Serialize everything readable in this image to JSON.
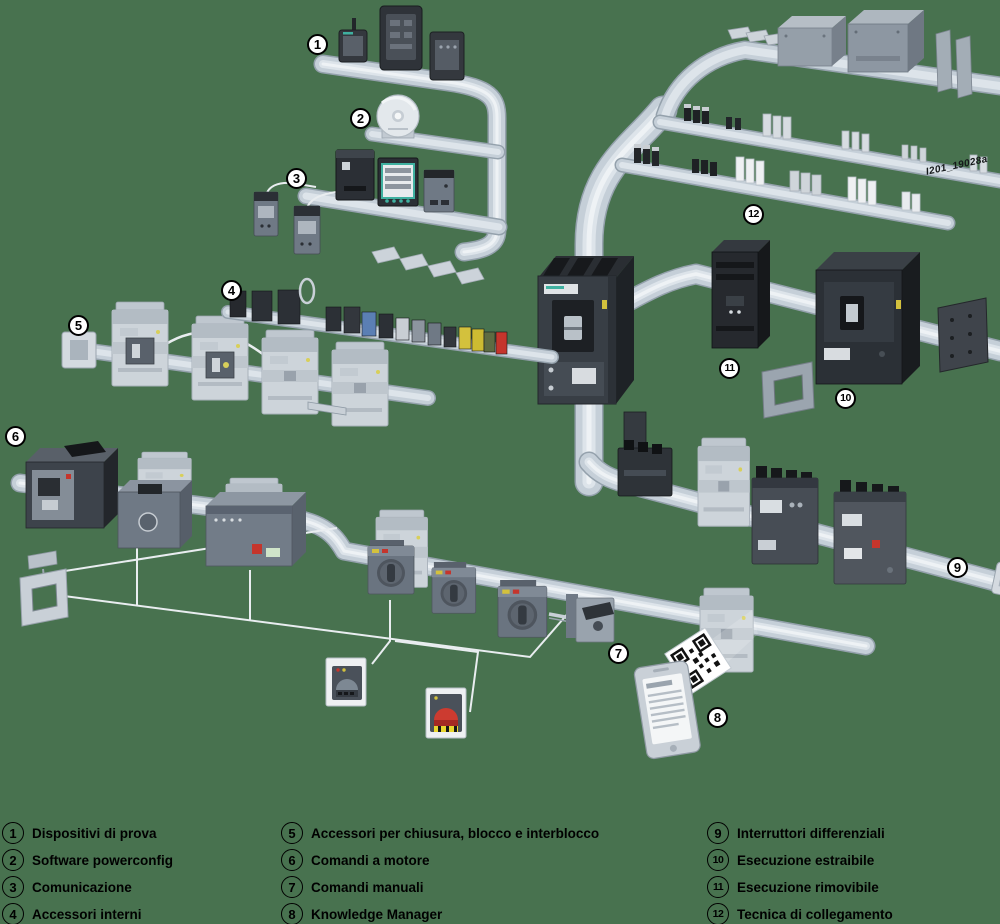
{
  "watermark": "I201_19028a",
  "colors": {
    "background": "#48724f",
    "pipe": "#c5cfd8",
    "pipe_shadow": "#94a1ac",
    "pipe_highlight": "#e9eef2",
    "device_dark": "#26292e",
    "device_gray": "#6f7985",
    "device_light": "#cdd4da",
    "accent_teal": "#3fb0a0",
    "accent_red": "#c5352c",
    "accent_yellow": "#d3c13d",
    "accent_blue": "#5b7fb4",
    "accent_green": "#5d6b42",
    "wire": "#e9edf0",
    "text": "#000000",
    "callout_bg": "#ffffff"
  },
  "callouts": [
    {
      "num": "1"
    },
    {
      "num": "2"
    },
    {
      "num": "3"
    },
    {
      "num": "4"
    },
    {
      "num": "5"
    },
    {
      "num": "6"
    },
    {
      "num": "7"
    },
    {
      "num": "8"
    },
    {
      "num": "9"
    },
    {
      "num": "10"
    },
    {
      "num": "11"
    },
    {
      "num": "12"
    }
  ],
  "legend": {
    "items": [
      {
        "num": "1",
        "label": "Dispositivi di prova"
      },
      {
        "num": "2",
        "label": "Software powerconfig"
      },
      {
        "num": "3",
        "label": "Comunicazione"
      },
      {
        "num": "4",
        "label": "Accessori interni"
      },
      {
        "num": "5",
        "label": "Accessori per chiusura, blocco e interblocco"
      },
      {
        "num": "6",
        "label": "Comandi a motore"
      },
      {
        "num": "7",
        "label": "Comandi manuali"
      },
      {
        "num": "8",
        "label": "Knowledge Manager"
      },
      {
        "num": "9",
        "label": "Interruttori differenziali"
      },
      {
        "num": "10",
        "label": "Esecuzione estraibile"
      },
      {
        "num": "11",
        "label": "Esecuzione rimovibile"
      },
      {
        "num": "12",
        "label": "Tecnica di collegamento"
      }
    ]
  }
}
